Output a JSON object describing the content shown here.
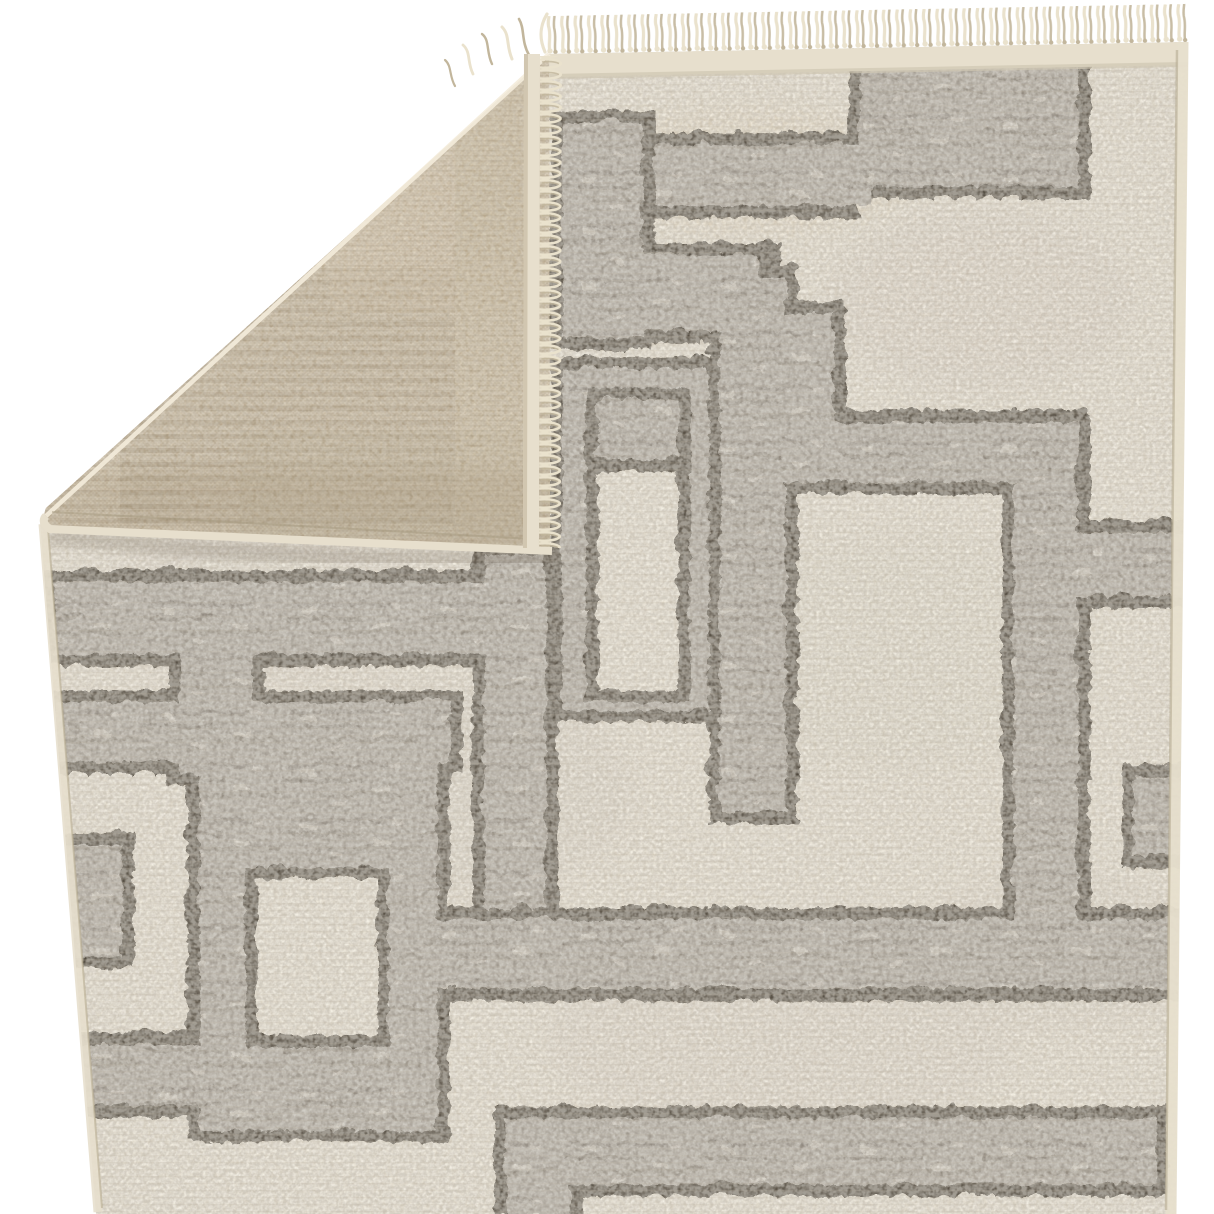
{
  "scene": {
    "type": "product-photograph",
    "subject": "Cream and gray geometric maze-pattern area rug",
    "view": "flat overhead view with the top-left corner folded over to reveal the woven backing",
    "background_color": "#ffffff",
    "elements": [
      "cream fringe tassels along the top edge",
      "folded corner flap showing tan flatweave backing with ghost of the pattern",
      "serged flap edge with short fringe lying on the pile",
      "high-low cut pile with speckled heathered texture",
      "interlocking rectangular maze pattern in mottled gray outlined in dark espresso"
    ]
  },
  "palette": {
    "background": "#ffffff",
    "rug_cream": "#e9e2d3",
    "rug_cream_dark": "#d6cec0",
    "pattern_gray": "#a49e95",
    "pattern_gray_light": "#cdc7bc",
    "pattern_dark": "#473f35",
    "backing_tan": "#d2c4ab",
    "backing_tan_dark": "#b4a489",
    "backing_line": "#9c8a6d",
    "fringe_cream": "#eae2cd",
    "fringe_shadow": "#c2b69c",
    "edge_binding": "#e7dfcd",
    "flap_shadow": "#55493a"
  },
  "rug": {
    "front": {
      "ground_color_name": "ivory cream",
      "pattern_fill_name": "heathered gray",
      "pattern_outline_name": "dark espresso brown",
      "texture": "speckled cut pile"
    },
    "backing": {
      "color_name": "tan flatweave",
      "detail": "mirrored maze pattern faintly visible as darker taupe blocks and fine horizontal stripe rows"
    },
    "fringe": {
      "location": "top edge",
      "color_name": "cream",
      "approx_tassel_count": 46,
      "tassel_length_px": 34
    },
    "fold": {
      "corner": "top-left",
      "crease_from": [
        549,
        54
      ],
      "crease_to": [
        40,
        522
      ],
      "flap_tip": [
        550,
        548
      ]
    },
    "pattern": {
      "outline_width": 12,
      "outer_dark": [
        [
          846,
          48,
          242,
          148
        ],
        [
          640,
          130,
          218,
          86
        ],
        [
          548,
          108,
          104,
          240
        ],
        [
          548,
          240,
          230,
          100
        ],
        [
          755,
          300,
          89,
          132
        ],
        [
          755,
          408,
          331,
          84
        ],
        [
          1000,
          408,
          88,
          512
        ],
        [
          1000,
          518,
          195,
          88
        ],
        [
          1120,
          762,
          75,
          104
        ],
        [
          706,
          262,
          90,
          560
        ],
        [
          548,
          355,
          170,
          365
        ],
        [
          40,
          568,
          462,
          96
        ],
        [
          470,
          540,
          86,
          378
        ],
        [
          166,
          664,
          96,
          120
        ],
        [
          40,
          688,
          420,
          84
        ],
        [
          185,
          744,
          263,
          396
        ],
        [
          40,
          1030,
          220,
          86
        ],
        [
          48,
          830,
          84,
          136
        ],
        [
          436,
          905,
          760,
          94
        ],
        [
          492,
          1104,
          674,
          90
        ],
        [
          492,
          1104,
          88,
          110
        ]
      ],
      "fill_gray": [
        [
          858,
          60,
          218,
          124
        ],
        [
          652,
          142,
          218,
          62
        ],
        [
          560,
          120,
          80,
          216
        ],
        [
          560,
          252,
          196,
          76
        ],
        [
          767,
          312,
          65,
          120
        ],
        [
          767,
          420,
          307,
          60
        ],
        [
          1012,
          420,
          64,
          510
        ],
        [
          1012,
          530,
          190,
          64
        ],
        [
          1132,
          774,
          63,
          80
        ],
        [
          718,
          274,
          66,
          536
        ],
        [
          560,
          367,
          146,
          341
        ],
        [
          52,
          580,
          442,
          72
        ],
        [
          482,
          552,
          62,
          354
        ],
        [
          178,
          640,
          72,
          132
        ],
        [
          52,
          700,
          396,
          60
        ],
        [
          197,
          744,
          239,
          384
        ],
        [
          52,
          1042,
          170,
          62
        ],
        [
          60,
          842,
          60,
          112
        ],
        [
          420,
          917,
          768,
          69
        ],
        [
          504,
          1116,
          650,
          66
        ],
        [
          504,
          1116,
          64,
          98
        ]
      ],
      "hole_dark": [
        [
          584,
          385,
          104,
          315
        ],
        [
          243,
          865,
          144,
          180
        ]
      ],
      "hole_cream": [
        [
          596,
          470,
          80,
          218
        ],
        [
          255,
          877,
          120,
          156
        ]
      ],
      "hole_gray": [
        [
          596,
          397,
          80,
          60
        ]
      ]
    }
  }
}
